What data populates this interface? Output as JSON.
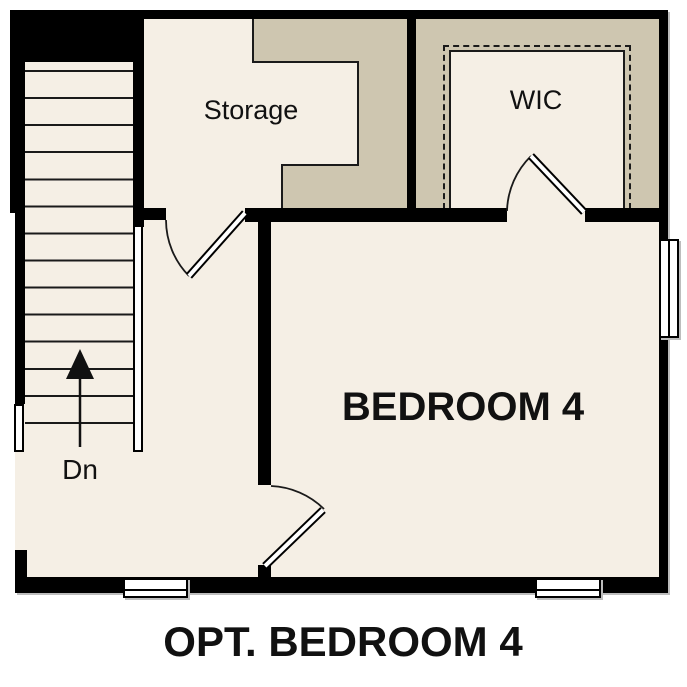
{
  "plan": {
    "title": "OPT. BEDROOM 4",
    "rooms": {
      "storage": {
        "label": "Storage"
      },
      "wic": {
        "label": "WIC"
      },
      "bedroom": {
        "label": "BEDROOM 4"
      },
      "stairs": {
        "label": "Dn",
        "direction": "down",
        "tread_count": 14
      }
    },
    "colors": {
      "wall": "#000000",
      "floor": "#f5efe5",
      "low_clearance": "#cec6b0",
      "background": "#ffffff"
    }
  }
}
